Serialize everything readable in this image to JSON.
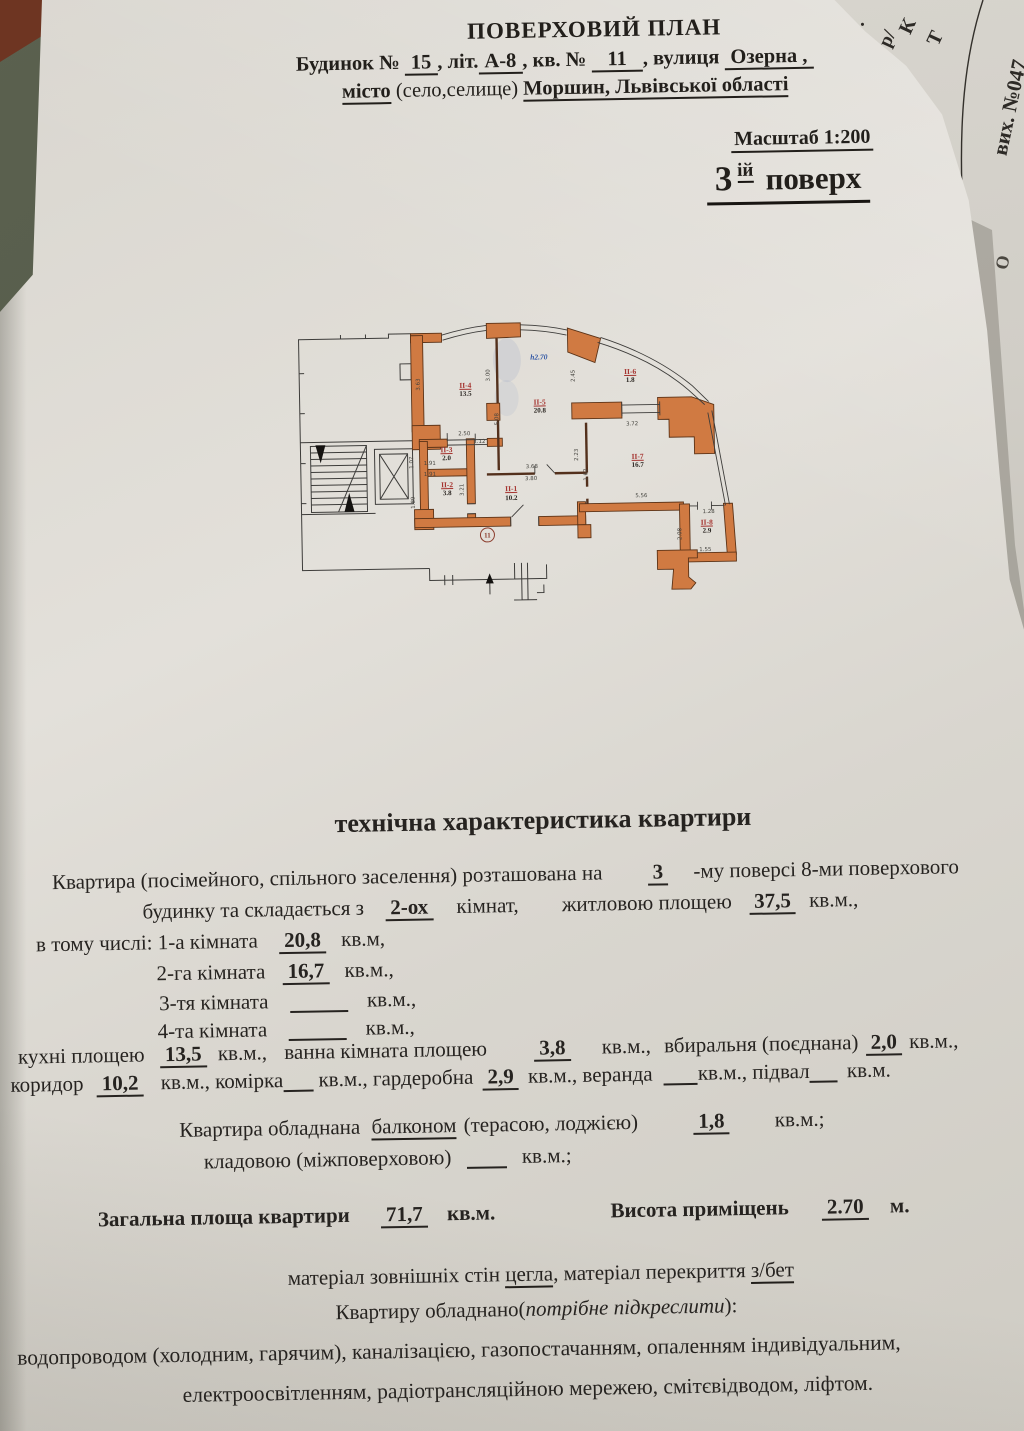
{
  "colors": {
    "wall_orange": "#d07a42",
    "room_label_red": "#a53430",
    "height_note_blue": "#2f55a4",
    "table_olive": "#555b4a"
  },
  "edge": {
    "f2": "к.",
    "f3": "8.",
    "f4": "р/",
    "f5": "К",
    "f6": "Т",
    "vykh": "вих. №047",
    "f7": "О"
  },
  "header": {
    "title": "ПОВЕРХОВИЙ ПЛАН",
    "l2a": "Будинок №",
    "l2v1": "15",
    "l2b": ", літ.",
    "l2v2": "А-8",
    "l2c": ", кв. №",
    "l2v3": "11",
    "l2d": ", вулиця",
    "l2v4": "Озерна ,",
    "l3a": "місто",
    "l3b": "(село,селище)",
    "l3v": "Моршин, Львівської області",
    "scale": "Масштаб 1:200",
    "floor_num": "3",
    "floor_sup": "ій",
    "floor_word": "поверх"
  },
  "plan": {
    "apartment_no": "11",
    "height_note": "h2.70",
    "rooms": {
      "r1": {
        "id": "ІІ-1",
        "area": "10.2"
      },
      "r2": {
        "id": "ІІ-2",
        "area": "3.8"
      },
      "r3": {
        "id": "ІІ-3",
        "area": "2.0"
      },
      "r4": {
        "id": "ІІ-4",
        "area": "13.5"
      },
      "r5": {
        "id": "ІІ-5",
        "area": "20.8"
      },
      "r6": {
        "id": "ІІ-6",
        "area": "1.8"
      },
      "r7": {
        "id": "ІІ-7",
        "area": "16.7"
      },
      "r8": {
        "id": "ІІ-8",
        "area": "2.9"
      }
    },
    "dims": {
      "d363": "3.63",
      "d300": "3.00",
      "d508": "5.08",
      "d245": "2.45",
      "d250": "2.50",
      "d112": "1.12",
      "d191a": "1.91",
      "d191b": "1.91",
      "d107": "1.07",
      "d189": "1.89",
      "d321": "3.21",
      "d368": "3.68",
      "d380": "3.80",
      "d223": "2.23",
      "d162": "1.62",
      "d372": "3.72",
      "d556": "5.56",
      "d128": "1.28",
      "d155": "1.55",
      "d208": "2.08"
    }
  },
  "tech": {
    "title": "технічна характеристика квартири",
    "p1a": "Квартира (посімейного, спільного заселення) розташована на",
    "p1v": "3",
    "p1b": "-му  поверсі 8-ми поверхового",
    "p2a": "будинку та складається з",
    "p2v": "2-ох",
    "p2b": "кімнат,",
    "p2c": "житловою площею",
    "p2v2": "37,5",
    "p2d": "кв.м.,",
    "r1a": "в тому числі: 1-а кімната",
    "r1v": "20,8",
    "r1b": "кв.м,",
    "r2a": "2-га кімната",
    "r2v": "16,7",
    "r2b": "кв.м.,",
    "r3a": "3-тя кімната",
    "r3b": "кв.м.,",
    "r4a": "4-та кімната",
    "r4b": "кв.м.,",
    "k1a": "кухні площею",
    "k1v": "13,5",
    "k1b": "кв.м.,",
    "k1c": "ванна кімната площею",
    "k1v2": "3,8",
    "k1d": "кв.м.,",
    "k1e": "вбиральня (поєднана)",
    "k1v3": "2,0",
    "k1f": "кв.м.,",
    "k2a": "коридор",
    "k2v": "10,2",
    "k2b": "кв.м., комірка",
    "k2c": "кв.м., гардеробна",
    "k2v2": "2,9",
    "k2d": "кв.м., веранда",
    "k2e": "кв.м., підвал",
    "k2f": "кв.м.",
    "b1a": "Квартира обладнана",
    "b1u": "балконом",
    "b1b": "(терасою, лоджією)",
    "b1v": "1,8",
    "b1c": "кв.м.;",
    "b2a": "кладовою (міжповерховою)",
    "b2b": "кв.м.;",
    "t1a": "Загальна площа квартири",
    "t1v": "71,7",
    "t1b": "кв.м.",
    "t2a": "Висота приміщень",
    "t2v": "2.70",
    "t2b": "м.",
    "m1a": "матеріал зовнішніх стін",
    "m1u": "цегла",
    "m1b": ", матеріал перекриття",
    "m1u2": "з/бет",
    "m2a": "Квартиру обладнано(",
    "m2i": "потрібне підкреслити",
    "m2b": "):",
    "m3": "водопроводом (холодним, гарячим), каналізацією, газопостачанням, опаленням  індивідуальним,",
    "m4": "електроосвітленням, радіотрансляційною мережею, смітєвідводом, ліфтом."
  }
}
